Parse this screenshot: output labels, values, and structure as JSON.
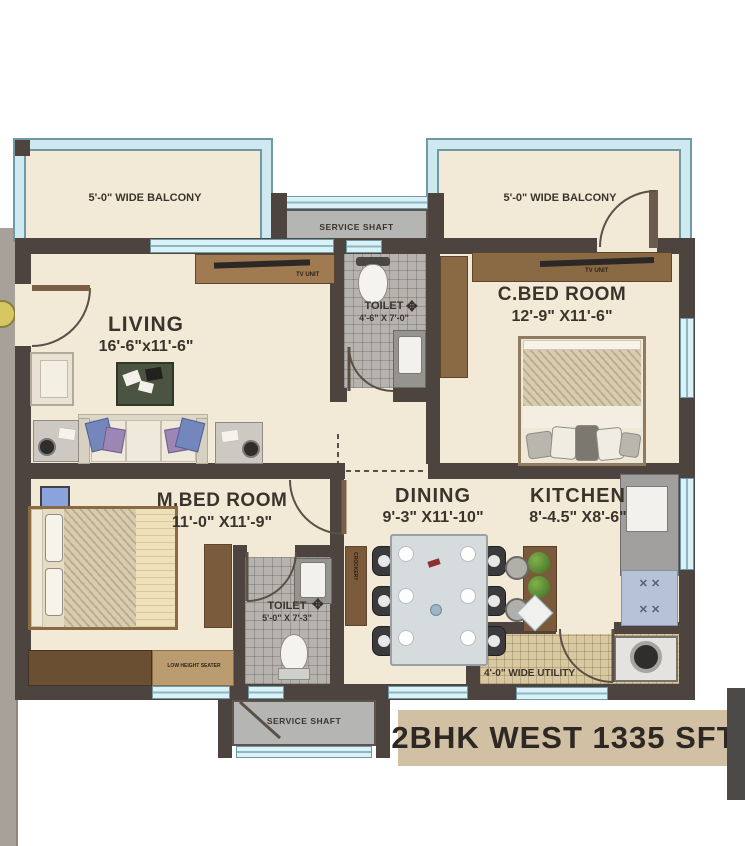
{
  "banner": {
    "text": "2BHK WEST  1335 SFT"
  },
  "balcony_left": {
    "label": "5'-0\" WIDE BALCONY"
  },
  "balcony_right": {
    "label": "5'-0\" WIDE BALCONY"
  },
  "service_shaft_top": {
    "label": "SERVICE SHAFT"
  },
  "service_shaft_bottom": {
    "label": "SERVICE SHAFT"
  },
  "rooms": {
    "living": {
      "name": "LIVING",
      "dims": "16'-6\"x11'-6\""
    },
    "toilet_common": {
      "name": "TOILET",
      "dims": "4'-6\" X 7'-0\""
    },
    "c_bed": {
      "name": "C.BED ROOM",
      "dims": "12'-9\" X11'-6\""
    },
    "m_bed": {
      "name": "M.BED ROOM",
      "dims": "11'-0\" X11'-9\""
    },
    "toilet_master": {
      "name": "TOILET",
      "dims": "5'-0\" X 7'-3\""
    },
    "dining": {
      "name": "DINING",
      "dims": "9'-3\" X11'-10\""
    },
    "kitchen": {
      "name": "KITCHEN",
      "dims": "8'-4.5\" X8'-6\""
    },
    "utility": {
      "label": "4'-0\" WIDE UTILITY"
    }
  },
  "furniture": {
    "tv_unit_living": "TV UNIT",
    "tv_unit_cbed": "TV UNIT",
    "low_height_unit": "LOW HEIGHT SEATER",
    "crockery_unit": "CROCKERY"
  },
  "colors": {
    "wall": "#4e443f",
    "floor": "#f2e9d7",
    "rail": "#cfe9f1",
    "banner_bg": "#d2c0a4",
    "wood": "#8a6a45"
  }
}
